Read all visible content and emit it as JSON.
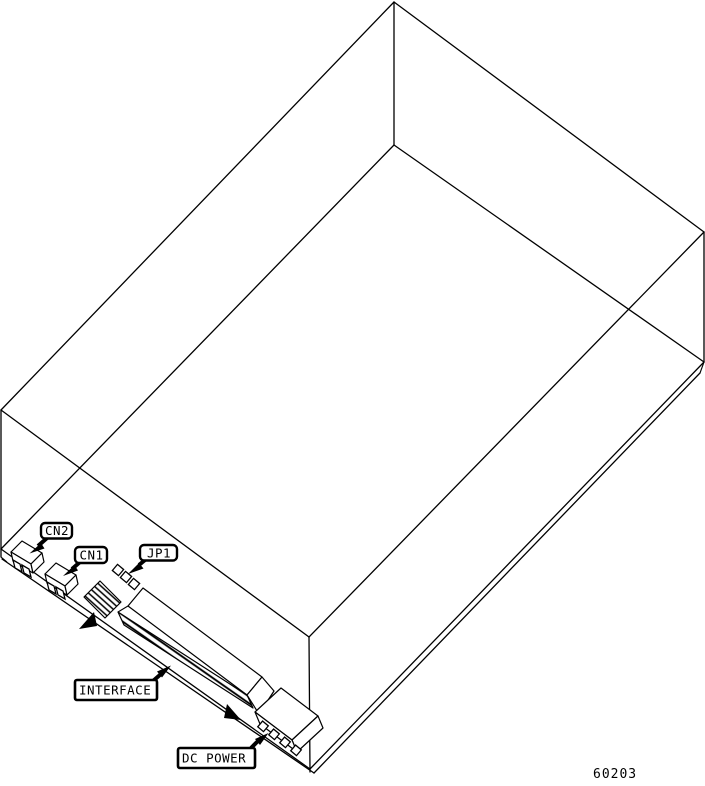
{
  "page": {
    "background_color": "#ffffff",
    "line_color": "#000000"
  },
  "figure": {
    "labels": {
      "cn2": "CN2",
      "cn1": "CN1",
      "jp1": "JP1",
      "interface": "INTERFACE",
      "dc_power": "DC POWER"
    },
    "figure_number": "60203"
  }
}
